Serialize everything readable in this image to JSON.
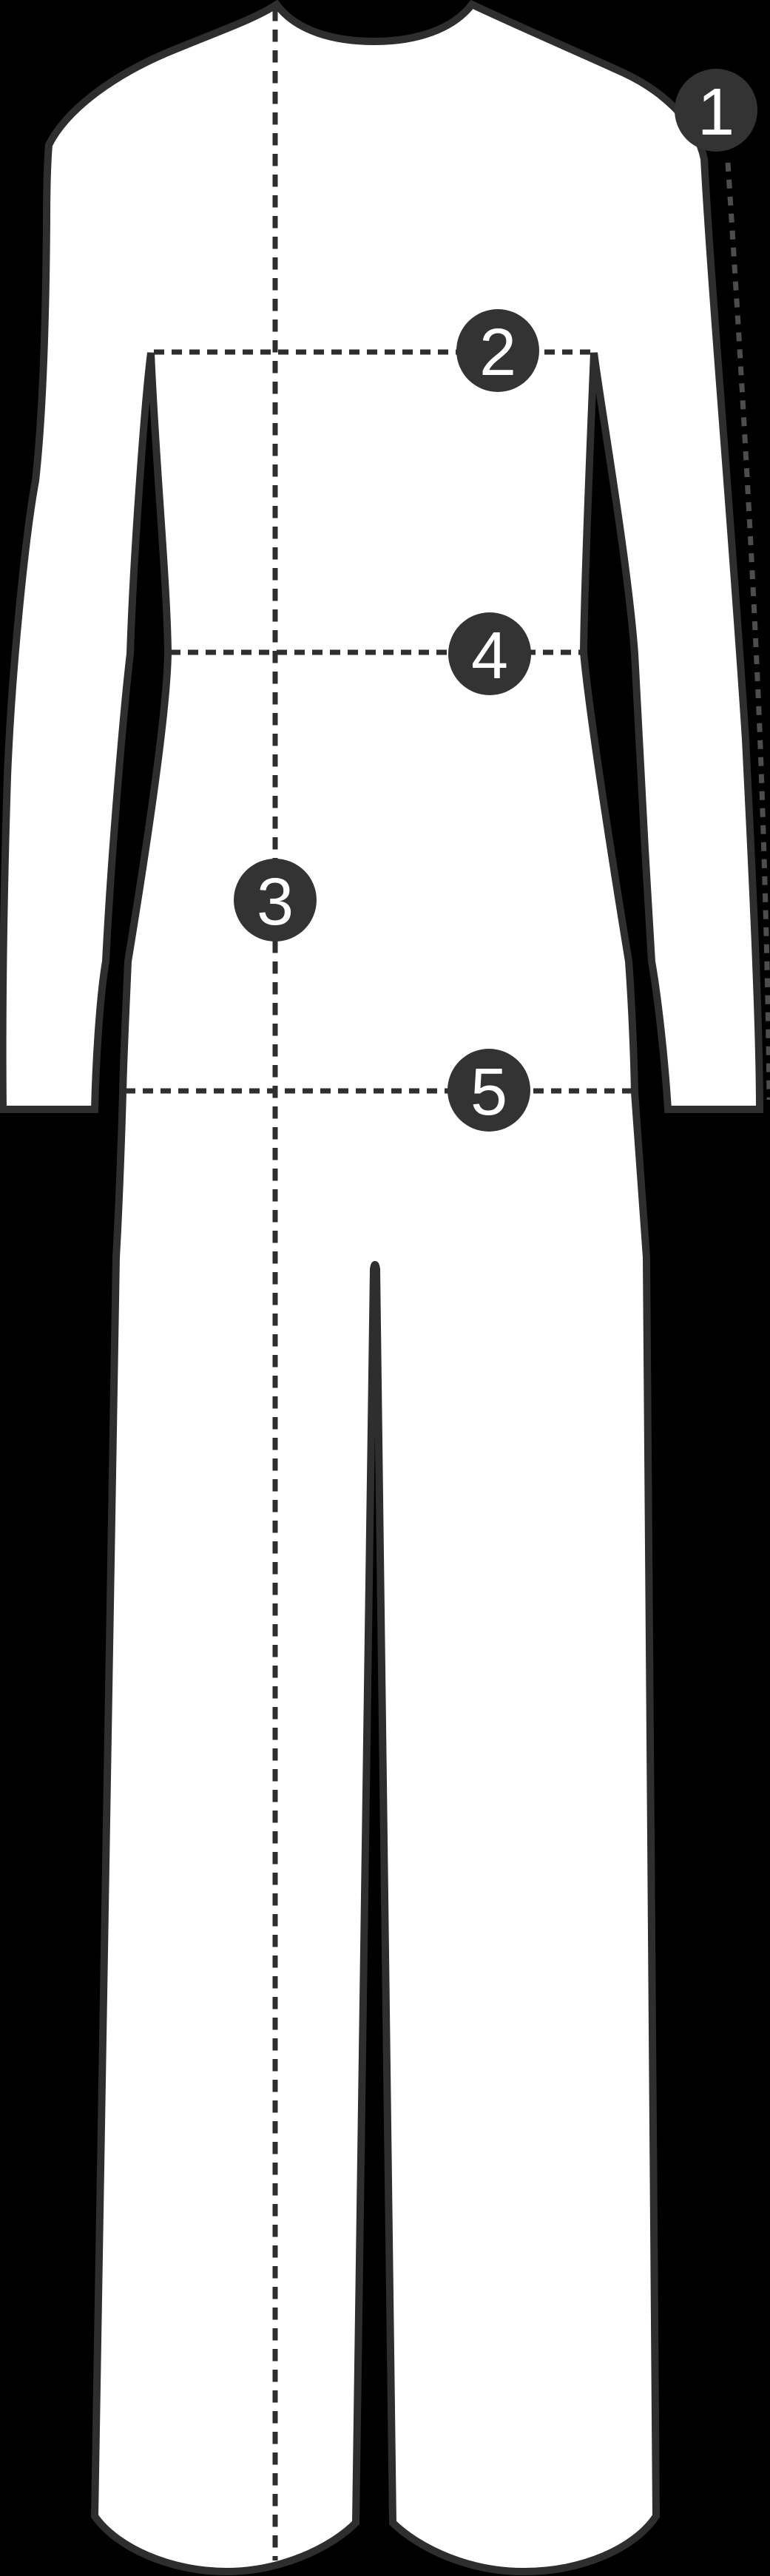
{
  "diagram": {
    "subject": "jumpsuit-front-outline-size-guide",
    "markers": [
      {
        "label": "1"
      },
      {
        "label": "2"
      },
      {
        "label": "3"
      },
      {
        "label": "4"
      },
      {
        "label": "5"
      }
    ]
  },
  "colors": {
    "background": "#000000",
    "garment_fill": "#ffffff",
    "garment_outline": "#2e2e2e",
    "dash_on_white": "#2e2e2e",
    "dash_on_black": "#4d4d4d",
    "marker_fill": "#333333",
    "marker_number": "#ffffff"
  }
}
